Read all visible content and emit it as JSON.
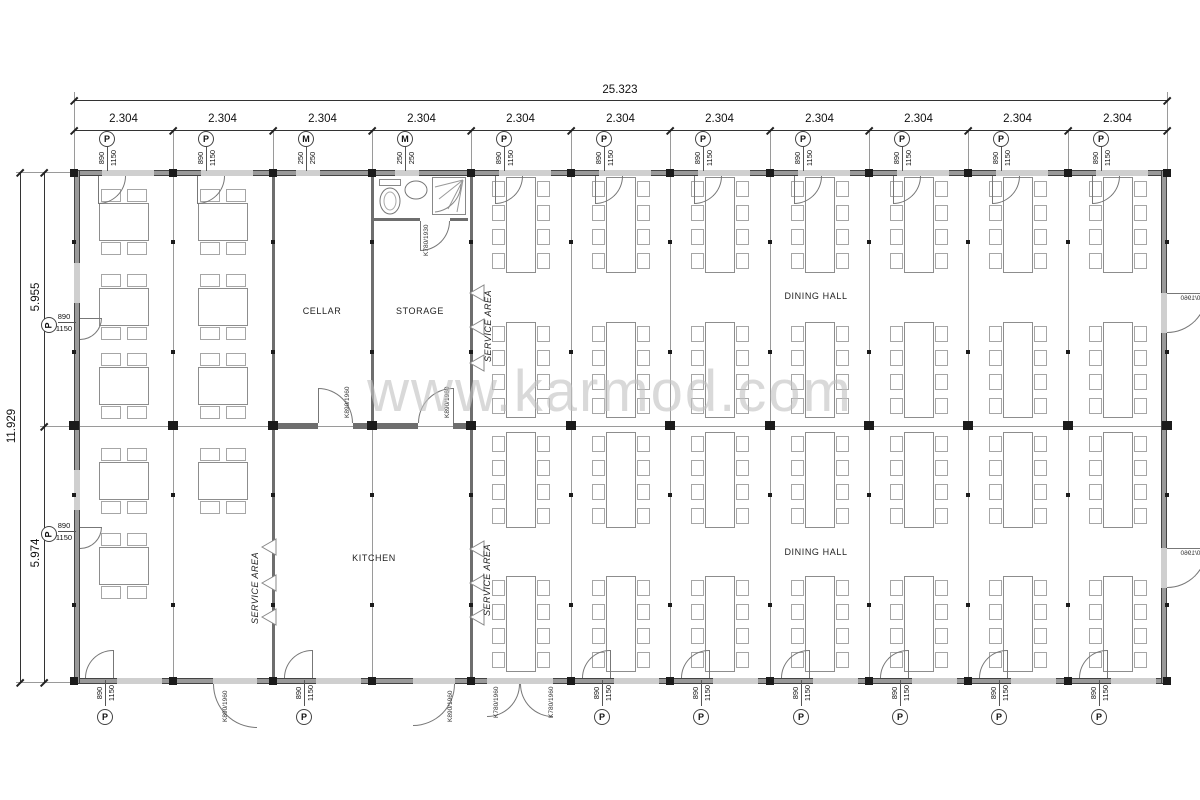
{
  "watermark": "www.karmod.com",
  "dimensions": {
    "overall_width": "25.323",
    "bay_width": "2.304",
    "overall_depth": "11.929",
    "upper_depth": "5.955",
    "lower_depth": "5.974"
  },
  "labels": {
    "cellar": "CELLAR",
    "storage": "STORAGE",
    "kitchen": "KITCHEN",
    "dining_hall_upper": "DINING HALL",
    "dining_hall_lower": "DINING HALL",
    "service_area": "SERVICE AREA"
  },
  "openings": {
    "window_P": {
      "symbol": "P",
      "width": "890",
      "height": "1150"
    },
    "window_M": {
      "symbol": "M",
      "width": "250",
      "height": "250"
    },
    "door_main": "K890/1960",
    "door_service": "K780/1960",
    "door_wc": "K780/1930"
  },
  "bays": {
    "count": 11,
    "top_openings": [
      "P",
      "P",
      "M",
      "M",
      "P",
      "P",
      "P",
      "P",
      "P",
      "P",
      "P"
    ],
    "bottom_openings": [
      "P",
      "DOOR_MAIN",
      "P",
      "DOOR_MAIN",
      "DOOR_SERVICE_PAIR",
      "P",
      "P",
      "P",
      "P",
      "P",
      "P"
    ],
    "left_wall_openings": [
      "P",
      "P"
    ],
    "right_wall_doors": [
      "DOOR_MAIN",
      "DOOR_MAIN"
    ]
  }
}
